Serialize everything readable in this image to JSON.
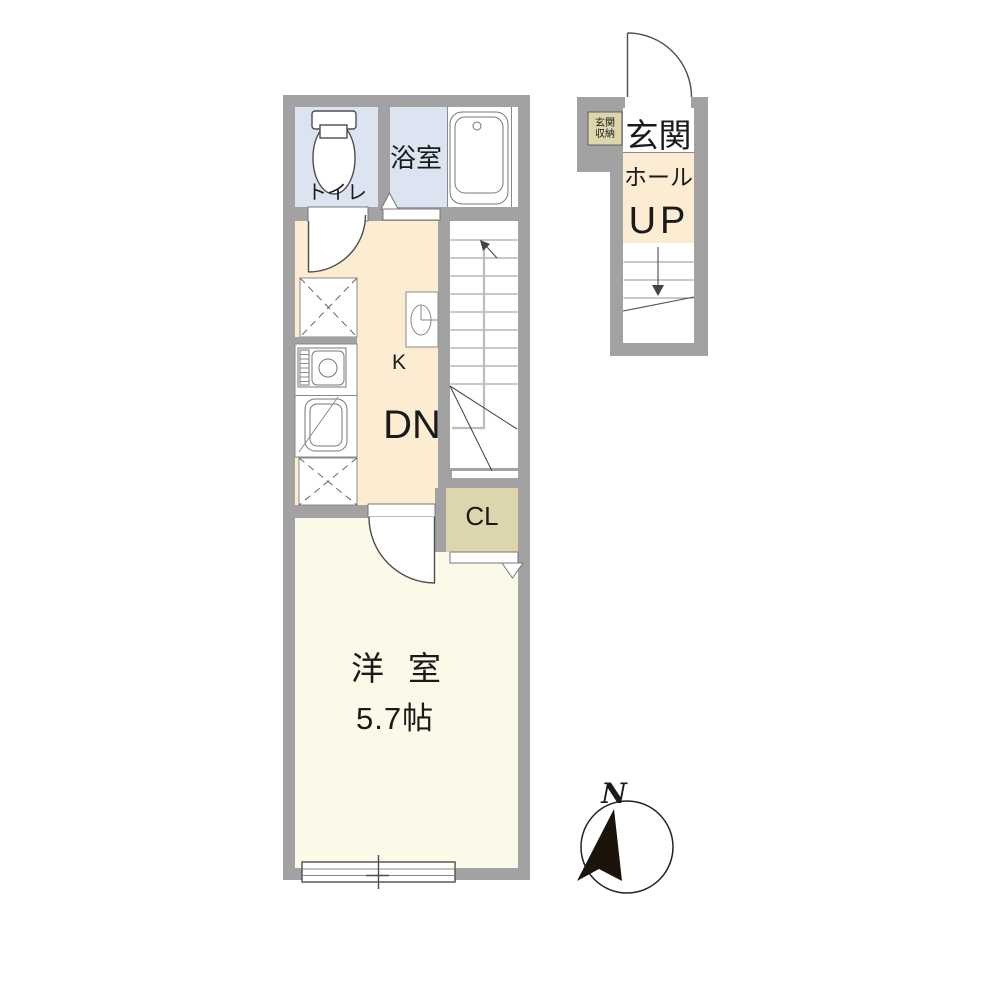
{
  "colors": {
    "wall": "#a2a2a2",
    "room_blue": "#dce3f1",
    "room_peach": "#fcecd2",
    "room_ivory": "#fbfae9",
    "closet_tan": "#ddd5ac",
    "line_dark": "#4d4d4d",
    "text": "#1a1a1a"
  },
  "main_unit": {
    "toilet_label": "トイレ",
    "bath_label": "浴室",
    "kitchen_label": "K",
    "stairs_down_label": "DN",
    "closet_label": "CL",
    "room_label": "洋室",
    "room_size": "5.7帖"
  },
  "entrance_unit": {
    "storage_line1": "玄関",
    "storage_line2": "収納",
    "entrance_label": "玄関",
    "hall_label": "ホール",
    "stairs_up_label": "UP"
  },
  "compass": {
    "north_label": "N"
  }
}
